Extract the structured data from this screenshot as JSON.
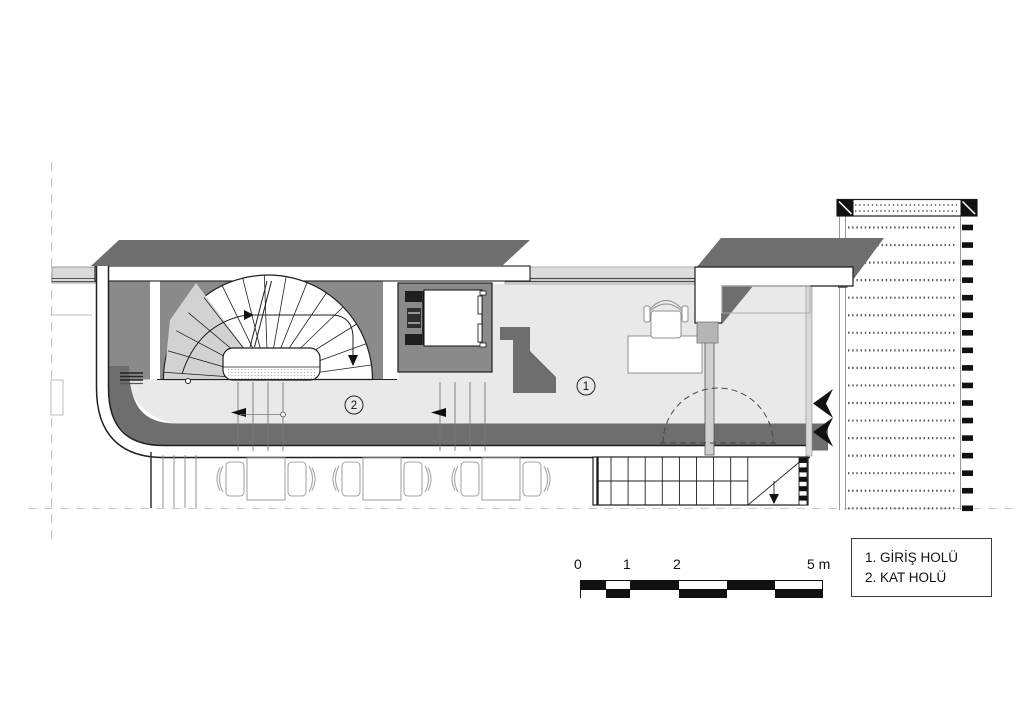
{
  "drawing": {
    "type": "architectural-floor-plan",
    "room_markers": [
      {
        "number": "1"
      },
      {
        "number": "2"
      }
    ]
  },
  "legend": {
    "items": [
      {
        "text": "1. GİRİŞ HOLÜ"
      },
      {
        "text": "2. KAT HOLÜ"
      }
    ]
  },
  "scale_bar": {
    "tick_labels": [
      {
        "text": "0"
      },
      {
        "text": "1"
      },
      {
        "text": "2"
      },
      {
        "text": "5 m"
      }
    ]
  },
  "colors": {
    "slab_dark": "#6e6e6e",
    "wall_gray": "#8a8a8a",
    "floor_light": "#e9e9e9",
    "glass_band": "#dcdcdc",
    "outline": "#1f1f1f",
    "construction_dash": "#c6c6c6"
  }
}
